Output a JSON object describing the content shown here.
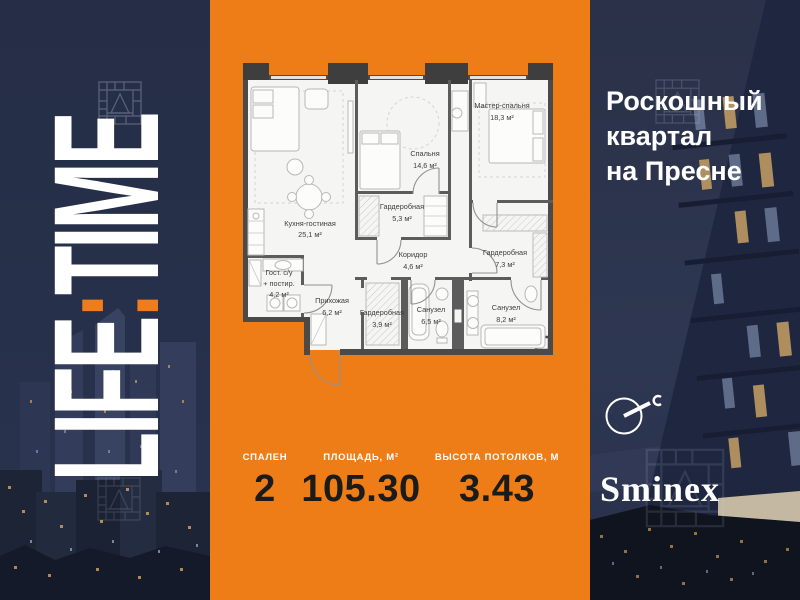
{
  "brand": {
    "life": "LIFE",
    "colon": ":",
    "time": "TIME",
    "developer": "Sminex"
  },
  "right_panel": {
    "headline": [
      "Роскошный",
      "квартал",
      "на Пресне"
    ]
  },
  "stats": [
    {
      "label": "СПАЛЕН",
      "value": "2"
    },
    {
      "label": "ПЛОЩАДЬ, М²",
      "value": "105.30"
    },
    {
      "label": "ВЫСОТА ПОТОЛКОВ, М",
      "value": "3.43"
    }
  ],
  "floorplan": {
    "rooms": [
      {
        "name": "Кухня-гостиная",
        "area": "25,1 м²"
      },
      {
        "name": "Спальня",
        "area": "14,6 м²"
      },
      {
        "name": "Мастер-спальня",
        "area": "18,3 м²"
      },
      {
        "name": "Гардеробная",
        "area": "5,3 м²"
      },
      {
        "name": "Коридор",
        "area": "4,6 м²"
      },
      {
        "name": "Гардеробная",
        "area": "7,3 м²"
      },
      {
        "name": "Гост. с/у",
        "name2": "+ постир.",
        "area": "4,2 м²"
      },
      {
        "name": "Прихожая",
        "area": "6,2 м²"
      },
      {
        "name": "Гардеробная",
        "area": "3,9 м²"
      },
      {
        "name": "Санузел",
        "area": "6,5 м²"
      },
      {
        "name": "Санузел",
        "area": "8,2 м²"
      }
    ]
  },
  "icons": {
    "compass": "north-arrow-icon",
    "ornament": "quilt-pattern-icon"
  },
  "colors": {
    "orange": "#ee7d17",
    "navy": "#272f48",
    "stat_value": "#1b1b19",
    "white": "#ffffff"
  }
}
